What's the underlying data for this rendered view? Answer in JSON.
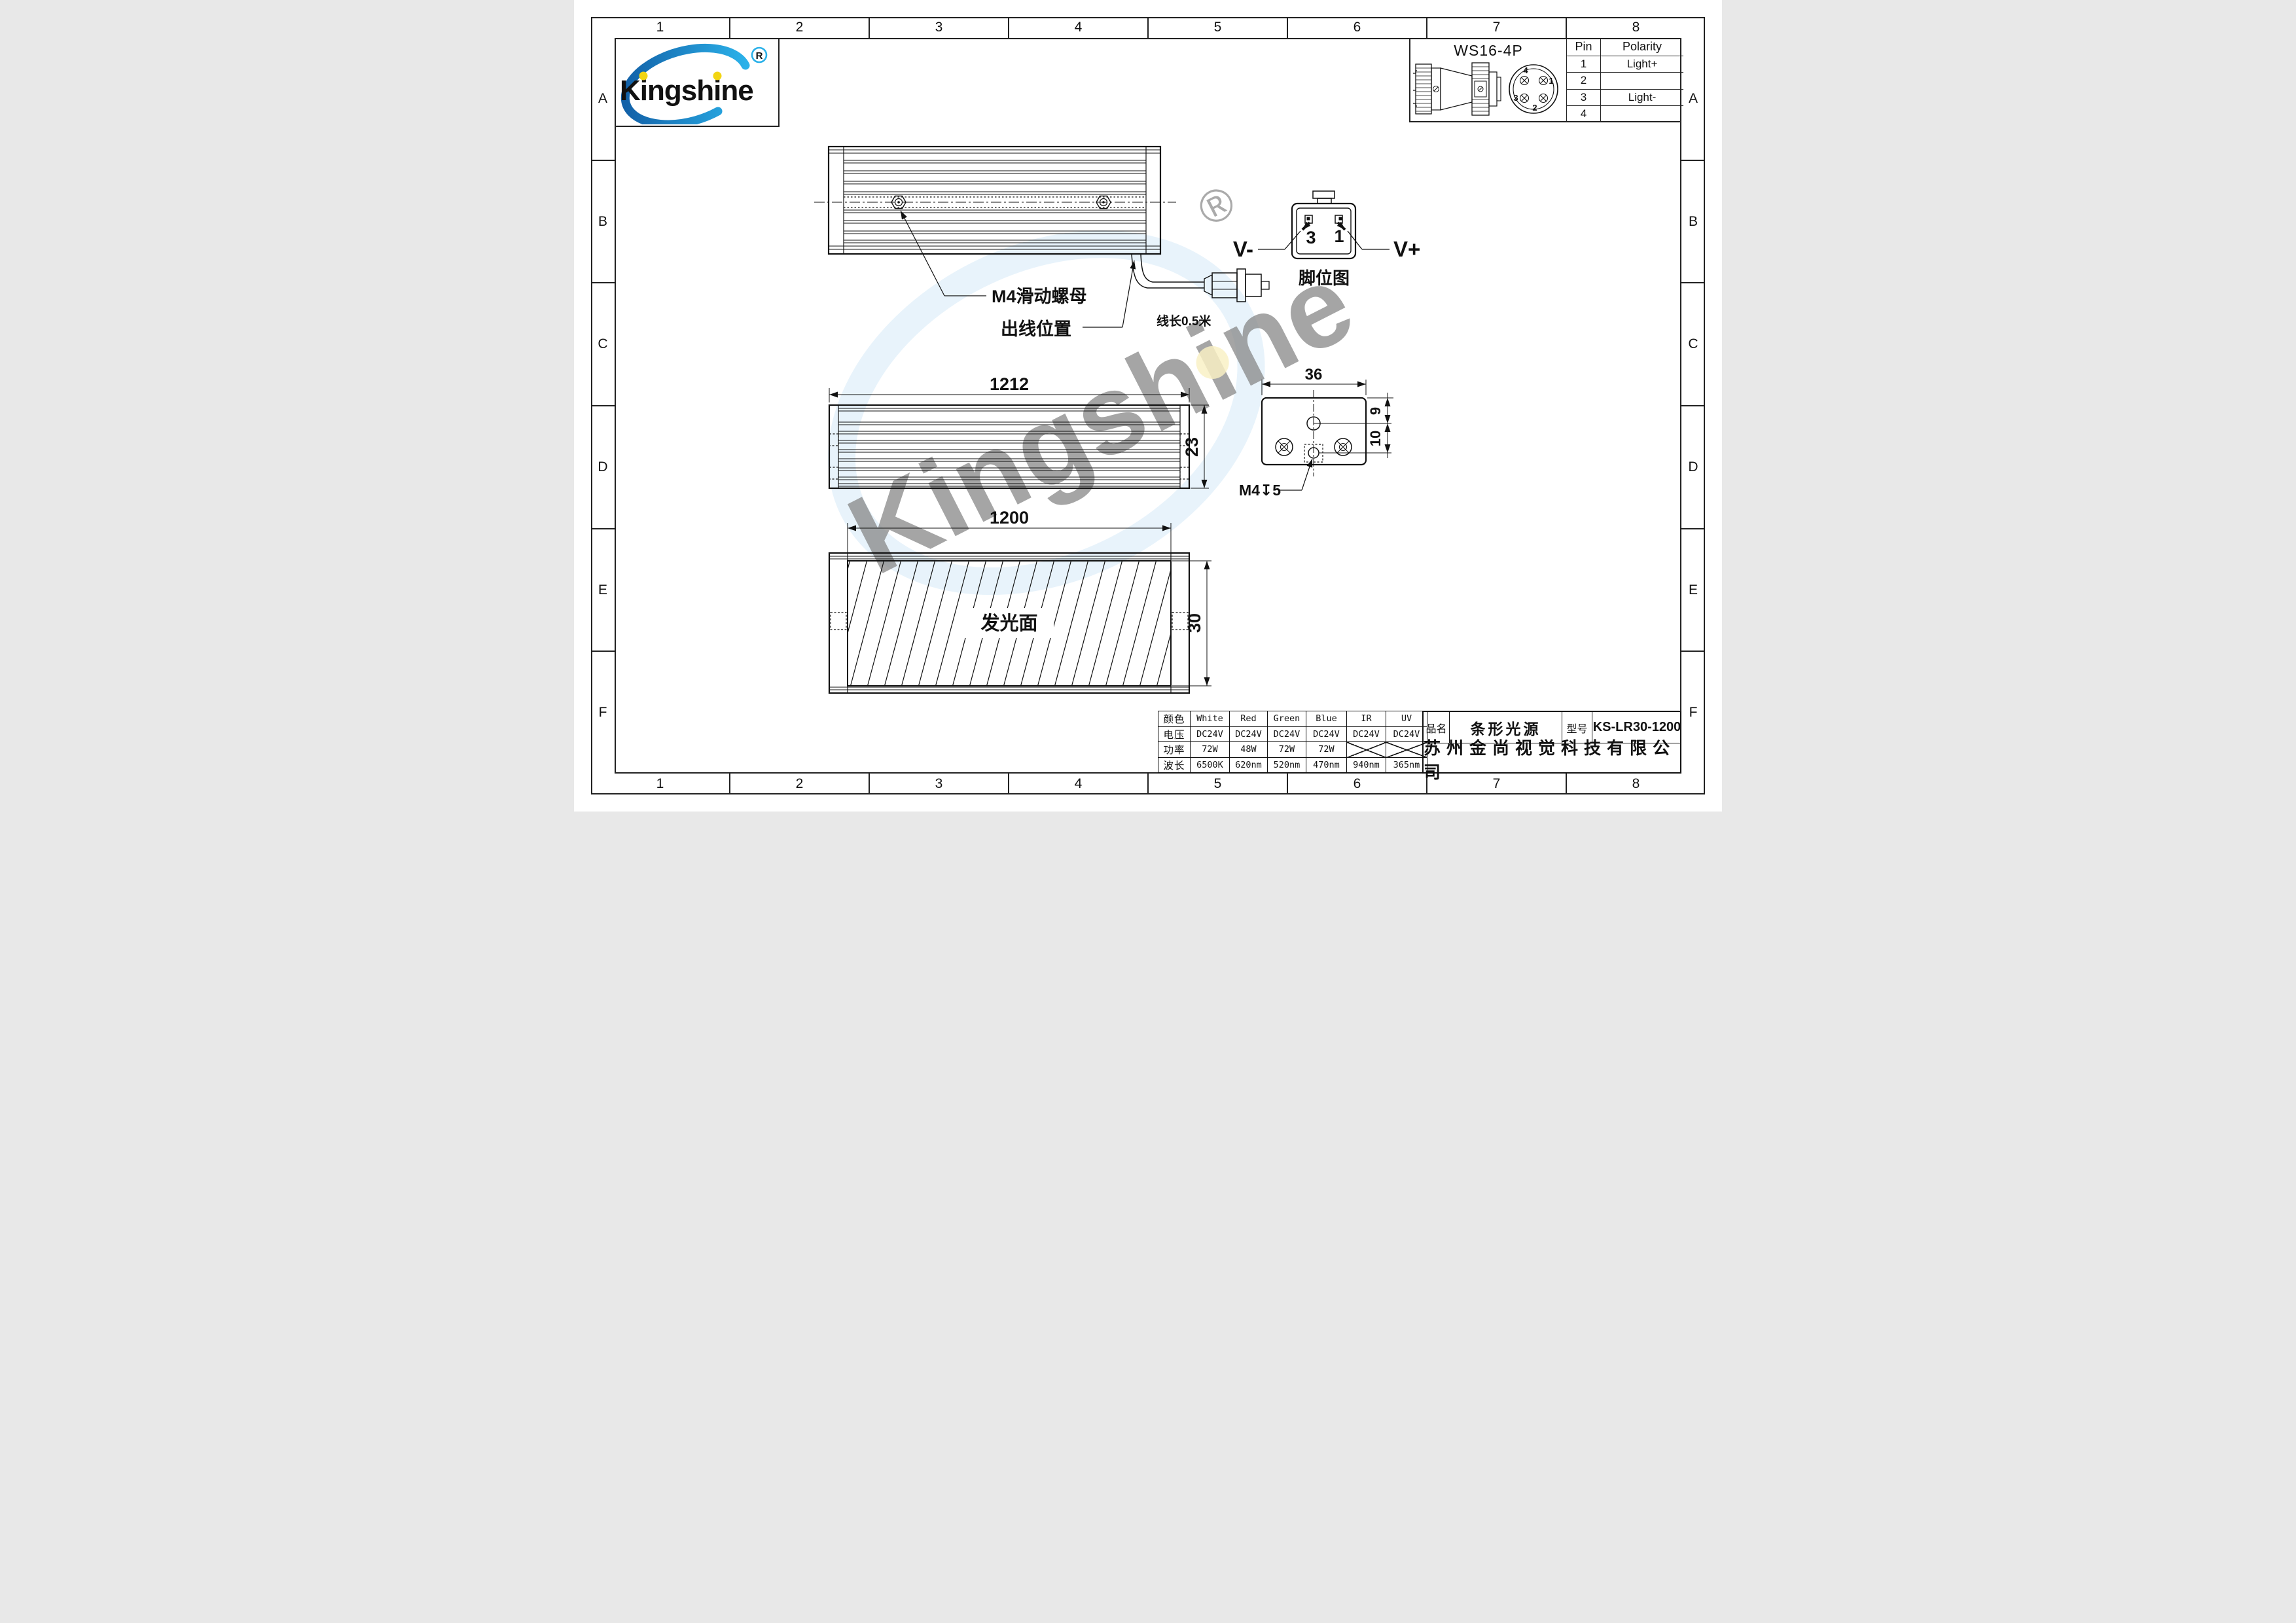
{
  "frame": {
    "columns": [
      "1",
      "2",
      "3",
      "4",
      "5",
      "6",
      "7",
      "8"
    ],
    "rows": [
      "A",
      "B",
      "C",
      "D",
      "E",
      "F"
    ]
  },
  "logo": {
    "text": "Kingshine",
    "registered": "R",
    "brand_blue": "#1c8ed6",
    "accent_yellow": "#f2d513"
  },
  "connector_detail": {
    "title": "WS16-4P",
    "table": {
      "headers": [
        "Pin",
        "Polarity"
      ],
      "rows": [
        {
          "pin": "1",
          "polarity": "Light+"
        },
        {
          "pin": "2",
          "polarity": ""
        },
        {
          "pin": "3",
          "polarity": "Light-"
        },
        {
          "pin": "4",
          "polarity": ""
        }
      ]
    },
    "face_pins": [
      "4",
      "1",
      "3",
      "2"
    ]
  },
  "top_view": {
    "nut_label": "M4滑动螺母",
    "outlet_label": "出线位置",
    "cable_label": "线长0.5米"
  },
  "pin_diagram": {
    "caption": "脚位图",
    "pin_left": "3",
    "pin_right": "1",
    "v_minus": "V-",
    "v_plus": "V+"
  },
  "side_view": {
    "length": "1212",
    "height": "23"
  },
  "end_view": {
    "width": "36",
    "offset_top": "9",
    "offset_mid": "10",
    "thread": "M4↧5"
  },
  "bottom_view": {
    "length": "1200",
    "height": "30",
    "face_label": "发光面"
  },
  "spec_table": {
    "header_label": "颜色",
    "headers": [
      "White",
      "Red",
      "Green",
      "Blue",
      "IR",
      "UV"
    ],
    "rows": [
      {
        "label": "电压",
        "values": [
          "DC24V",
          "DC24V",
          "DC24V",
          "DC24V",
          "DC24V",
          "DC24V"
        ]
      },
      {
        "label": "功率",
        "values": [
          "72W",
          "48W",
          "72W",
          "72W",
          null,
          null
        ]
      },
      {
        "label": "波长",
        "values": [
          "6500K",
          "620nm",
          "520nm",
          "470nm",
          "940nm",
          "365nm"
        ]
      }
    ]
  },
  "title_block": {
    "name_label": "品名",
    "name": "条形光源",
    "model_label": "型号",
    "model": "KS-LR30-1200",
    "company": "苏州金尚视觉科技有限公司"
  },
  "watermark": {
    "text": "Kingshine"
  }
}
